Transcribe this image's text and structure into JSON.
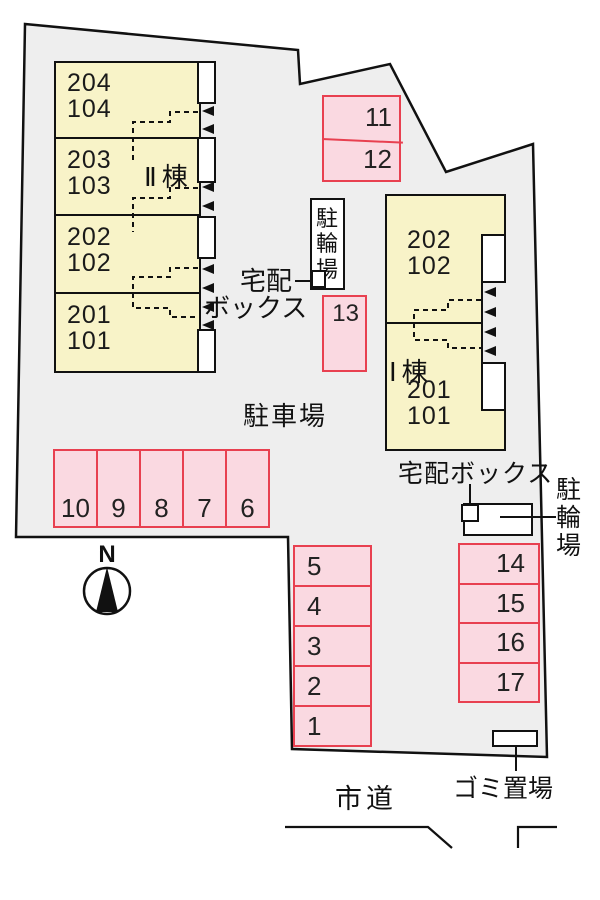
{
  "colors": {
    "parking_fill": "#fad9e1",
    "parking_border": "#e84050",
    "building_fill": "#f8f3c8",
    "plot_fill": "#eeeeee",
    "line": "#111111"
  },
  "buildings": {
    "b2": {
      "name": "Ⅱ棟",
      "units": [
        {
          "upper": "204",
          "lower": "104"
        },
        {
          "upper": "203",
          "lower": "103"
        },
        {
          "upper": "202",
          "lower": "102"
        },
        {
          "upper": "201",
          "lower": "101"
        }
      ]
    },
    "b1": {
      "name": "Ⅰ棟",
      "unit_top": {
        "upper": "202",
        "lower": "102"
      },
      "unit_bottom": {
        "upper": "201",
        "lower": "101"
      }
    }
  },
  "parking": {
    "row": [
      "10",
      "9",
      "8",
      "7",
      "6"
    ],
    "pair": [
      "11",
      "12"
    ],
    "single": "13",
    "col_left": [
      "5",
      "4",
      "3",
      "2",
      "1"
    ],
    "col_right": [
      "14",
      "15",
      "16",
      "17"
    ]
  },
  "labels": {
    "parking_lot": "駐車場",
    "bike_top": "駐輪場",
    "delivery_top_line1": "宅配",
    "delivery_top_line2": "ボックス",
    "delivery_bottom": "宅配ボックス",
    "bike_right": "駐輪場",
    "garbage": "ゴミ置場",
    "road": "市道",
    "north": "N"
  }
}
